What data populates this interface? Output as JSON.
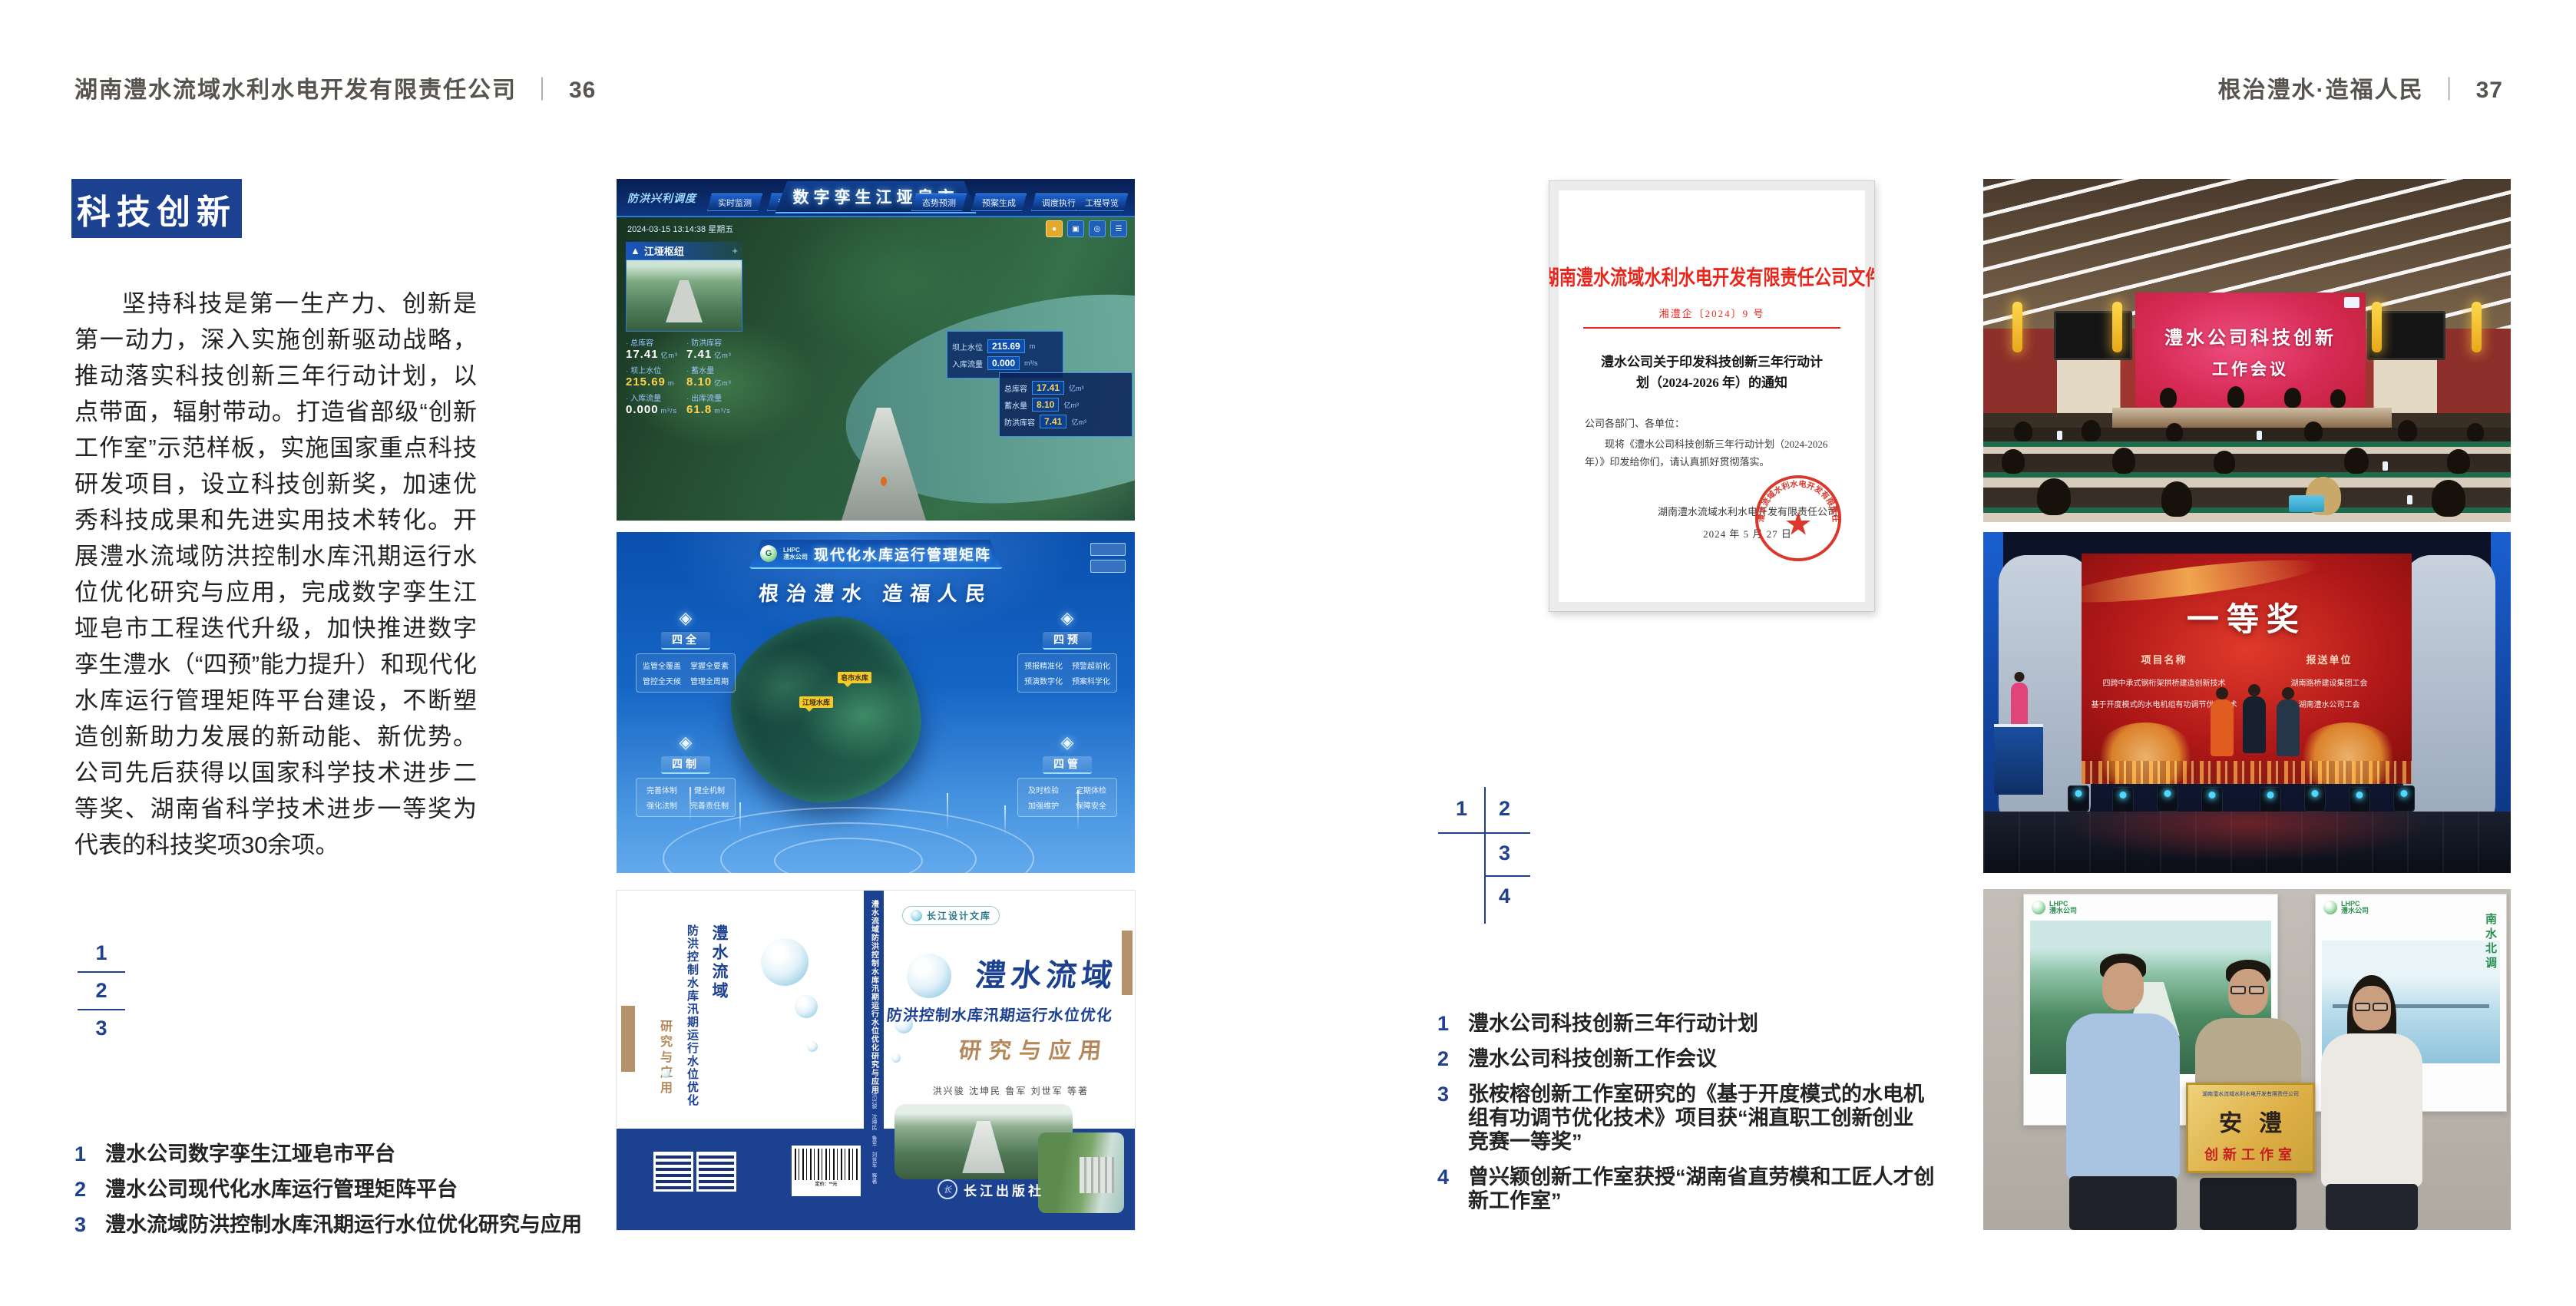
{
  "pageLeft": {
    "header": "湖南澧水流域水利水电开发有限责任公司",
    "sep": "｜",
    "pageNo": "36",
    "sectionTitle": "科技创新",
    "body": "坚持科技是第一生产力、创新是第一动力，深入实施创新驱动战略，推动落实科技创新三年行动计划，以点带面，辐射带动。打造省部级“创新工作室”示范样板，实施国家重点科技研发项目，设立科技创新奖，加速优秀科技成果和先进实用技术转化。开展澧水流域防洪控制水库汛期运行水位优化研究与应用，完成数字孪生江垭皂市工程迭代升级，加快推进数字孪生澧水（“四预”能力提升）和现代化水库运行管理矩阵平台建设，不断塑造创新助力发展的新动能、新优势。公司先后获得以国家科学技术进步二等奖、湖南省科学技术进步一等奖为代表的科技奖项30余项。",
    "figIndex": [
      "1",
      "2",
      "3"
    ],
    "captions": [
      {
        "n": "1",
        "t": "澧水公司数字孪生江垭皂市平台"
      },
      {
        "n": "2",
        "t": "澧水公司现代化水库运行管理矩阵平台"
      },
      {
        "n": "3",
        "t": "澧水流域防洪控制水库汛期运行水位优化研究与应用"
      }
    ]
  },
  "pageRight": {
    "header": "根治澧水·造福人民",
    "sep": "｜",
    "pageNo": "37",
    "figIndex": [
      "1",
      "2",
      "3",
      "4"
    ],
    "captions": [
      {
        "n": "1",
        "t": "澧水公司科技创新三年行动计划"
      },
      {
        "n": "2",
        "t": "澧水公司科技创新工作会议"
      },
      {
        "n": "3",
        "t": "张桉榕创新工作室研究的《基于开度模式的水电机组有功调节优化技术》项目获“湘直职工创新创业竞赛一等奖”"
      },
      {
        "n": "4",
        "t": "曾兴颖创新工作室获授“湖南省直劳模和工匠人才创新工作室”"
      }
    ]
  },
  "dashboard": {
    "menu": "防洪兴利调度",
    "tabsLeft": [
      "实时监测",
      "洪水预报",
      "防洪预警"
    ],
    "title": "数字孪生江垭皂市",
    "tabsRight": [
      "态势预测",
      "预案生成",
      "调度执行",
      "工程导览"
    ],
    "timestamp": "2024-03-15 13:14:38 星期五",
    "station": {
      "title": "江垭枢纽",
      "stats": [
        {
          "label": "总库容",
          "value": "17.41",
          "unit": "亿m³"
        },
        {
          "label": "防洪库容",
          "value": "7.41",
          "unit": "亿m³"
        },
        {
          "label": "坝上水位",
          "value": "215.69",
          "unit": "m"
        },
        {
          "label": "蓄水量",
          "value": "8.10",
          "unit": "亿m³"
        },
        {
          "label": "入库流量",
          "value": "0.000",
          "unit": "m³/s"
        },
        {
          "label": "出库流量",
          "value": "61.8",
          "unit": "m³/s"
        }
      ]
    },
    "tooltip": {
      "rows": [
        {
          "label": "坝上水位",
          "value": "215.69",
          "unit": "m"
        },
        {
          "label": "入库流量",
          "value": "0.000",
          "unit": "m³/s"
        }
      ]
    },
    "info": {
      "rows": [
        {
          "label": "总库容",
          "value": "17.41",
          "unit": "亿m³"
        },
        {
          "label": "蓄水量",
          "value": "8.10",
          "unit": "亿m³"
        },
        {
          "label": "防洪库容",
          "value": "7.41",
          "unit": "亿m³"
        }
      ]
    }
  },
  "matrix": {
    "logo": "G",
    "logoLine1": "LHPC",
    "logoLine2": "澧水公司",
    "title": "现代化水库运行管理矩阵",
    "slogan": "根治澧水 造福人民",
    "panels": [
      {
        "title": "四全",
        "items": [
          "监管全覆盖",
          "掌握全要素",
          "管控全天候",
          "管理全周期"
        ]
      },
      {
        "title": "四预",
        "items": [
          "预报精准化",
          "预警超前化",
          "预演数字化",
          "预案科学化"
        ]
      },
      {
        "title": "四制",
        "items": [
          "完善体制",
          "健全机制",
          "强化法制",
          "完善责任制"
        ]
      },
      {
        "title": "四管",
        "items": [
          "及时检验",
          "定期体检",
          "加强维护",
          "保障安全"
        ]
      }
    ],
    "markers": [
      "皂市水库",
      "江垭水库"
    ]
  },
  "book": {
    "series": "长江设计文库",
    "titleMain": "澧水流域",
    "titleSub": "防洪控制水库汛期运行水位优化",
    "titleAccent": "研究与应用",
    "authors": "洪兴骏  沈坤民  鲁军  刘世军  等著",
    "spineTitle": "澧水流域防洪控制水库汛期运行水位优化研究与应用",
    "publisherInitial": "长",
    "publisher": "长江出版社",
    "backTitle1": "澧水流域",
    "backTitle2": "防洪控制水库汛期运行水位优化",
    "backAccent": "研究与应用",
    "barcodeCaption": "定价：**元"
  },
  "officialDoc": {
    "orgHeader": "湖南澧水流域水利水电开发有限责任公司文件",
    "docNo": "湘澧企〔2024〕9 号",
    "title": "澧水公司关于印发科技创新三年行动计划（2024-2026 年）的通知",
    "salutation": "公司各部门、各单位：",
    "body": "现将《澧水公司科技创新三年行动计划（2024-2026 年）》印发给你们，请认真抓好贯彻落实。",
    "signer": "湖南澧水流域水利水电开发有限责任公司",
    "date": "2024 年 5 月 27 日",
    "sealText": "湖南澧水流域水利水电开发有限责任公司",
    "sealStar": "★"
  },
  "meeting": {
    "screenLine1": "澧水公司科技创新",
    "screenLine2": "工作会议"
  },
  "award": {
    "title": "一等奖",
    "colProject": "项目名称",
    "colOrg": "报送单位",
    "rows": [
      {
        "project": "四跨中承式钢桁架拱桥建造创新技术",
        "org": "湖南路桥建设集团工会"
      },
      {
        "project": "基于开度模式的水电机组有功调节优化技术",
        "org": "湖南澧水公司工会"
      }
    ]
  },
  "plaque": {
    "posterVertical": "南水北调",
    "logoLine1": "LHPC",
    "logoLine2": "澧水公司",
    "header": "湖南澧水流域水利水电开发有限责任公司",
    "calligraphy": "安澧",
    "subtitle": "创新工作室"
  },
  "colors": {
    "brandBlue": "#1c4191",
    "captionBlue": "#21418c",
    "docRed": "#e8261c",
    "bookTan": "#b4926a"
  }
}
